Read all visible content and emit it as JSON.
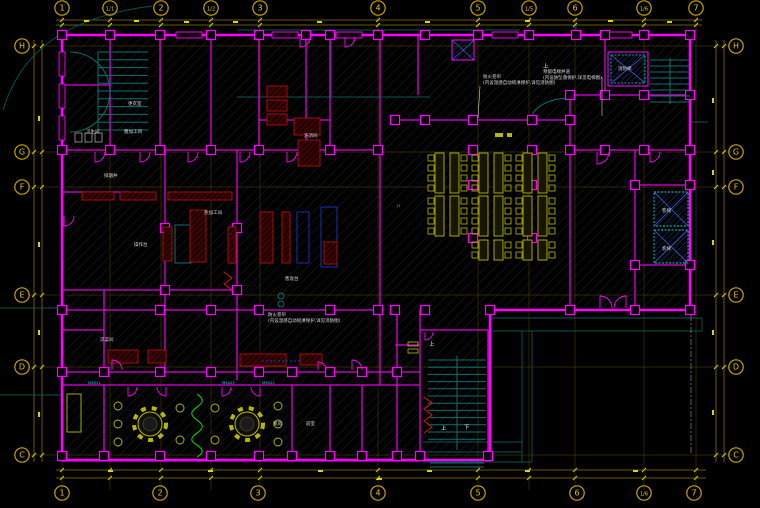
{
  "drawing": {
    "type": "architectural-floor-plan",
    "colors": {
      "background": "#000000",
      "wall": "#ff00ff",
      "grid_bubble": "#c8a200",
      "grid_label": "#e8c800",
      "dimension": "#d8d800",
      "stair": "#0c7070",
      "equipment": "#b01010",
      "fixture_blue": "#2233cc",
      "furniture": "#b8b800",
      "elevator_hatch": "#00cccc",
      "annotation": "#dcdcdc",
      "door_tag": "#00dddd",
      "plant_screen": "#00cc00"
    },
    "grid": {
      "top": [
        {
          "label": "1",
          "x": 62
        },
        {
          "label": "1/1",
          "x": 110
        },
        {
          "label": "2",
          "x": 161
        },
        {
          "label": "1/2",
          "x": 211
        },
        {
          "label": "3",
          "x": 260
        },
        {
          "label": "4",
          "x": 378
        },
        {
          "label": "5",
          "x": 478
        },
        {
          "label": "1/5",
          "x": 529
        },
        {
          "label": "6",
          "x": 575
        },
        {
          "label": "1/6",
          "x": 644
        },
        {
          "label": "7",
          "x": 696
        }
      ],
      "bottom": [
        {
          "label": "1",
          "x": 62
        },
        {
          "label": "2",
          "x": 160
        },
        {
          "label": "3",
          "x": 258
        },
        {
          "label": "4",
          "x": 378
        },
        {
          "label": "5",
          "x": 478
        },
        {
          "label": "6",
          "x": 577
        },
        {
          "label": "1/6",
          "x": 644
        },
        {
          "label": "7",
          "x": 694
        }
      ],
      "left": [
        {
          "label": "H",
          "y": 46
        },
        {
          "label": "G",
          "y": 152
        },
        {
          "label": "F",
          "y": 187
        },
        {
          "label": "E",
          "y": 295
        },
        {
          "label": "D",
          "y": 367
        },
        {
          "label": "C",
          "y": 455
        }
      ],
      "right": [
        {
          "label": "H",
          "y": 46
        },
        {
          "label": "G",
          "y": 152
        },
        {
          "label": "F",
          "y": 187
        },
        {
          "label": "E",
          "y": 295
        },
        {
          "label": "D",
          "y": 367
        },
        {
          "label": "C",
          "y": 455
        }
      ]
    },
    "annotations": [
      {
        "x": 483,
        "y": 78,
        "lines": [
          "防火卷帘",
          "(内设温感自动喷淋保护,详见消防图)"
        ]
      },
      {
        "x": 543,
        "y": 73,
        "lines": [
          "预留电梯井道",
          "(内设防坠落保护,详见电梯图)"
        ]
      },
      {
        "x": 268,
        "y": 316,
        "lines": [
          "防火卷帘",
          "(内设温感自动喷淋保护,详见消防图)"
        ]
      }
    ],
    "room_labels": [
      {
        "x": 128,
        "y": 105,
        "t": "更衣室"
      },
      {
        "x": 86,
        "y": 133,
        "t": "卫生间"
      },
      {
        "x": 124,
        "y": 133,
        "t": "粗加工间"
      },
      {
        "x": 104,
        "y": 177,
        "t": "排烟井"
      },
      {
        "x": 204,
        "y": 214,
        "t": "热加工间"
      },
      {
        "x": 134,
        "y": 246,
        "t": "操作台"
      },
      {
        "x": 285,
        "y": 280,
        "t": "售饭台"
      },
      {
        "x": 100,
        "y": 341,
        "t": "凉菜间"
      },
      {
        "x": 304,
        "y": 137,
        "t": "洗消间"
      },
      {
        "x": 273,
        "y": 425,
        "t": "库房"
      },
      {
        "x": 306,
        "y": 425,
        "t": "前室"
      },
      {
        "x": 662,
        "y": 212,
        "t": "客梯"
      },
      {
        "x": 662,
        "y": 250,
        "t": "客梯"
      },
      {
        "x": 618,
        "y": 70,
        "t": "消防梯"
      }
    ],
    "stair_labels": [
      {
        "x": 543,
        "y": 68,
        "t": "上"
      },
      {
        "x": 429,
        "y": 346,
        "t": "上"
      },
      {
        "x": 441,
        "y": 430,
        "t": "上"
      },
      {
        "x": 464,
        "y": 429,
        "t": "下"
      }
    ],
    "door_tags": [
      {
        "x": 88,
        "y": 384,
        "t": "M1021"
      },
      {
        "x": 222,
        "y": 384,
        "t": "M1022"
      },
      {
        "x": 262,
        "y": 384,
        "t": "M1022"
      },
      {
        "x": 397,
        "y": 207,
        "t": "J1"
      }
    ]
  }
}
